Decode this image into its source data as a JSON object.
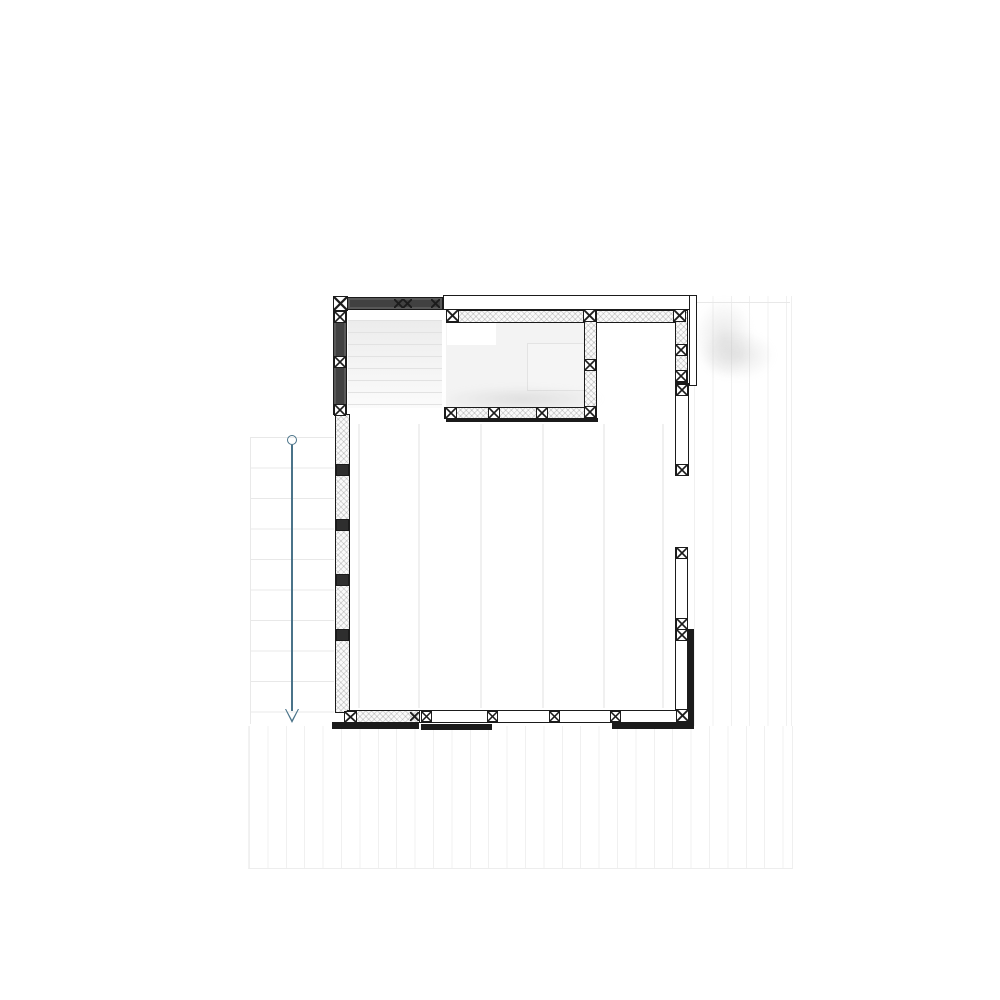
{
  "app": {
    "type": "floor-plan-editor-canvas",
    "drawing": "deck-framing-plan",
    "visible_text": ""
  },
  "colors": {
    "wall_line": "#1b1b1b",
    "wall_dark": "#414141",
    "hatch_bg": "#fafafa",
    "band": "#1b1b1b",
    "dimension": "#4a7389",
    "grid_line": "#e8e8e8",
    "stripe_line": "#f0f0f0",
    "fill_light": "#f3f3f3"
  },
  "canvas": {
    "width": 1000,
    "height": 1000
  },
  "plan": {
    "elements": [
      {
        "name": "stairs-area",
        "cls": "stairs",
        "x": 348,
        "y": 320,
        "w": 94,
        "h": 88,
        "interactable": false
      },
      {
        "name": "upper-room-fill",
        "cls": "plain",
        "x": 446,
        "y": 322,
        "w": 140,
        "h": 86,
        "bg": "#f3f3f3",
        "interactable": false
      },
      {
        "name": "upper-room-white-box",
        "cls": "plain",
        "x": 447,
        "y": 322,
        "w": 49,
        "h": 23,
        "bg": "#ffffff",
        "interactable": false
      },
      {
        "name": "upper-room-inner-box",
        "cls": "plain",
        "x": 527,
        "y": 343,
        "w": 59,
        "h": 48,
        "bg": "#f5f5f5",
        "border": "#e3e3e3",
        "interactable": false
      },
      {
        "name": "joist-line",
        "cls": "joist",
        "x": 358,
        "y": 424,
        "w": 2,
        "h": 284,
        "interactable": false
      },
      {
        "name": "joist-line",
        "cls": "joist",
        "x": 418,
        "y": 424,
        "w": 2,
        "h": 284,
        "interactable": false
      },
      {
        "name": "joist-line",
        "cls": "joist",
        "x": 480,
        "y": 424,
        "w": 2,
        "h": 284,
        "interactable": false
      },
      {
        "name": "joist-line",
        "cls": "joist",
        "x": 542,
        "y": 424,
        "w": 2,
        "h": 284,
        "interactable": false
      },
      {
        "name": "joist-line",
        "cls": "joist",
        "x": 603,
        "y": 424,
        "w": 2,
        "h": 284,
        "interactable": false
      },
      {
        "name": "joist-line",
        "cls": "joist",
        "x": 662,
        "y": 424,
        "w": 2,
        "h": 284,
        "interactable": false
      },
      {
        "name": "shadow-smudge",
        "cls": "smudge",
        "x": 694,
        "y": 298,
        "w": 60,
        "h": 80,
        "interactable": false
      },
      {
        "name": "shadow-smudge",
        "cls": "smudge",
        "x": 700,
        "y": 330,
        "w": 75,
        "h": 50,
        "interactable": false
      },
      {
        "name": "shadow-smudge",
        "cls": "smudge",
        "x": 440,
        "y": 386,
        "w": 165,
        "h": 26,
        "interactable": false
      },
      {
        "name": "edge-shadow-line",
        "cls": "plain",
        "x": 697,
        "y": 302,
        "w": 93,
        "h": 1,
        "bg": "#e8e8e8",
        "interactable": false
      },
      {
        "name": "top-wall-left",
        "cls": "dark",
        "x": 347,
        "y": 297,
        "w": 96,
        "h": 13,
        "interactable": true
      },
      {
        "name": "top-wall",
        "cls": "frame",
        "x": 443,
        "y": 295,
        "w": 250,
        "h": 15,
        "interactable": true
      },
      {
        "name": "top-interior-wall",
        "cls": "hatch",
        "x": 446,
        "y": 310,
        "w": 242,
        "h": 13,
        "interactable": true
      },
      {
        "name": "center-interior-wall",
        "cls": "hatch",
        "x": 584,
        "y": 310,
        "w": 13,
        "h": 110,
        "interactable": true
      },
      {
        "name": "mid-interior-wall",
        "cls": "hatch",
        "x": 444,
        "y": 407,
        "w": 153,
        "h": 12,
        "interactable": true
      },
      {
        "name": "mid-wall-band",
        "cls": "band",
        "x": 446,
        "y": 418,
        "w": 152,
        "h": 4,
        "interactable": true
      },
      {
        "name": "right-interior-wall",
        "cls": "hatch",
        "x": 675,
        "y": 310,
        "w": 13,
        "h": 73,
        "interactable": true
      },
      {
        "name": "right-outer-wall",
        "cls": "frame",
        "x": 689,
        "y": 295,
        "w": 8,
        "h": 91,
        "interactable": true
      },
      {
        "name": "right-wall-segment-a",
        "cls": "frame",
        "x": 675,
        "y": 383,
        "w": 14,
        "h": 93,
        "interactable": true
      },
      {
        "name": "right-wall-segment-b",
        "cls": "frame",
        "x": 675,
        "y": 547,
        "w": 13,
        "h": 85,
        "interactable": true
      },
      {
        "name": "right-wall-segment-c",
        "cls": "frame",
        "x": 675,
        "y": 629,
        "w": 13,
        "h": 85,
        "interactable": true
      },
      {
        "name": "right-rim-band",
        "cls": "band",
        "x": 687,
        "y": 629,
        "w": 7,
        "h": 94,
        "interactable": true
      },
      {
        "name": "left-wall-upper",
        "cls": "dark",
        "x": 333,
        "y": 310,
        "w": 14,
        "h": 105,
        "interactable": true
      },
      {
        "name": "left-wall",
        "cls": "hatch",
        "x": 335,
        "y": 414,
        "w": 15,
        "h": 299,
        "interactable": true
      },
      {
        "name": "bottom-wall-left",
        "cls": "hatch",
        "x": 347,
        "y": 710,
        "w": 74,
        "h": 13,
        "interactable": true
      },
      {
        "name": "bottom-wall",
        "cls": "frame",
        "x": 419,
        "y": 710,
        "w": 271,
        "h": 13,
        "interactable": true
      },
      {
        "name": "bottom-rim-left",
        "cls": "band",
        "x": 332,
        "y": 722,
        "w": 87,
        "h": 7,
        "interactable": true
      },
      {
        "name": "bottom-rim-mid",
        "cls": "band",
        "x": 421,
        "y": 724,
        "w": 71,
        "h": 6,
        "interactable": true
      },
      {
        "name": "bottom-rim-right",
        "cls": "band",
        "x": 612,
        "y": 722,
        "w": 82,
        "h": 7,
        "interactable": true
      },
      {
        "name": "corner-post",
        "cls": "post",
        "x": 333,
        "y": 296,
        "w": 15,
        "h": 15,
        "interactable": true
      },
      {
        "name": "stud-mark",
        "cls": "xsmall",
        "x": 394,
        "y": 299,
        "w": 9,
        "h": 9,
        "interactable": true
      },
      {
        "name": "stud-mark",
        "cls": "xsmall",
        "x": 403,
        "y": 299,
        "w": 9,
        "h": 9,
        "interactable": true
      },
      {
        "name": "stud-mark",
        "cls": "xsmall",
        "x": 431,
        "y": 299,
        "w": 9,
        "h": 9,
        "interactable": true
      },
      {
        "name": "post",
        "cls": "post",
        "x": 334,
        "y": 311,
        "w": 12,
        "h": 12,
        "interactable": true
      },
      {
        "name": "post",
        "cls": "post",
        "x": 334,
        "y": 356,
        "w": 12,
        "h": 12,
        "interactable": true
      },
      {
        "name": "post",
        "cls": "post",
        "x": 334,
        "y": 404,
        "w": 12,
        "h": 12,
        "interactable": true
      },
      {
        "name": "left-wall-post",
        "cls": "dark-post",
        "x": 336,
        "y": 464,
        "w": 13,
        "h": 12,
        "interactable": true
      },
      {
        "name": "left-wall-post",
        "cls": "dark-post",
        "x": 336,
        "y": 519,
        "w": 13,
        "h": 12,
        "interactable": true
      },
      {
        "name": "left-wall-post",
        "cls": "dark-post",
        "x": 336,
        "y": 574,
        "w": 13,
        "h": 12,
        "interactable": true
      },
      {
        "name": "left-wall-post",
        "cls": "dark-post",
        "x": 336,
        "y": 629,
        "w": 13,
        "h": 12,
        "interactable": true
      },
      {
        "name": "corner-post",
        "cls": "post",
        "x": 344,
        "y": 711,
        "w": 13,
        "h": 12,
        "interactable": true
      },
      {
        "name": "post",
        "cls": "post",
        "x": 446,
        "y": 309,
        "w": 13,
        "h": 13,
        "interactable": true
      },
      {
        "name": "post",
        "cls": "post",
        "x": 583,
        "y": 309,
        "w": 13,
        "h": 13,
        "interactable": true
      },
      {
        "name": "post",
        "cls": "post",
        "x": 673,
        "y": 309,
        "w": 13,
        "h": 13,
        "interactable": true
      },
      {
        "name": "post",
        "cls": "post",
        "x": 584,
        "y": 359,
        "w": 12,
        "h": 12,
        "interactable": true
      },
      {
        "name": "post",
        "cls": "post",
        "x": 584,
        "y": 406,
        "w": 12,
        "h": 12,
        "interactable": true
      },
      {
        "name": "post",
        "cls": "post",
        "x": 445,
        "y": 407,
        "w": 12,
        "h": 12,
        "interactable": true
      },
      {
        "name": "post",
        "cls": "post",
        "x": 488,
        "y": 407,
        "w": 12,
        "h": 12,
        "interactable": true
      },
      {
        "name": "post",
        "cls": "post",
        "x": 536,
        "y": 407,
        "w": 12,
        "h": 12,
        "interactable": true
      },
      {
        "name": "post",
        "cls": "post",
        "x": 675,
        "y": 344,
        "w": 12,
        "h": 12,
        "interactable": true
      },
      {
        "name": "post",
        "cls": "post",
        "x": 675,
        "y": 370,
        "w": 12,
        "h": 12,
        "interactable": true
      },
      {
        "name": "post",
        "cls": "post",
        "x": 676,
        "y": 384,
        "w": 12,
        "h": 12,
        "interactable": true
      },
      {
        "name": "post",
        "cls": "post",
        "x": 676,
        "y": 464,
        "w": 12,
        "h": 12,
        "interactable": true
      },
      {
        "name": "post",
        "cls": "post",
        "x": 676,
        "y": 547,
        "w": 12,
        "h": 12,
        "interactable": true
      },
      {
        "name": "post",
        "cls": "post",
        "x": 676,
        "y": 618,
        "w": 12,
        "h": 12,
        "interactable": true
      },
      {
        "name": "post",
        "cls": "post",
        "x": 676,
        "y": 629,
        "w": 12,
        "h": 12,
        "interactable": true
      },
      {
        "name": "corner-post",
        "cls": "post",
        "x": 676,
        "y": 709,
        "w": 13,
        "h": 13,
        "interactable": true
      },
      {
        "name": "stud-mark",
        "cls": "xsmall",
        "x": 410,
        "y": 712,
        "w": 9,
        "h": 9,
        "interactable": true
      },
      {
        "name": "post",
        "cls": "post",
        "x": 421,
        "y": 711,
        "w": 11,
        "h": 11,
        "interactable": true
      },
      {
        "name": "post",
        "cls": "post",
        "x": 487,
        "y": 711,
        "w": 11,
        "h": 11,
        "interactable": true
      },
      {
        "name": "post",
        "cls": "post",
        "x": 549,
        "y": 711,
        "w": 11,
        "h": 11,
        "interactable": true
      },
      {
        "name": "post",
        "cls": "post",
        "x": 610,
        "y": 711,
        "w": 11,
        "h": 11,
        "interactable": true
      },
      {
        "name": "dimension-handle-circle",
        "cls": "dim-circle",
        "x": 287,
        "y": 435,
        "w": 10,
        "h": 10,
        "interactable": true
      },
      {
        "name": "dimension-line",
        "cls": "dim-line",
        "x": 291,
        "y": 445,
        "w": 2,
        "h": 266,
        "interactable": true
      },
      {
        "name": "dimension-arrow-icon",
        "cls": "dim-arrow",
        "x": 285,
        "y": 709,
        "w": 14,
        "h": 14,
        "interactable": true
      }
    ]
  }
}
